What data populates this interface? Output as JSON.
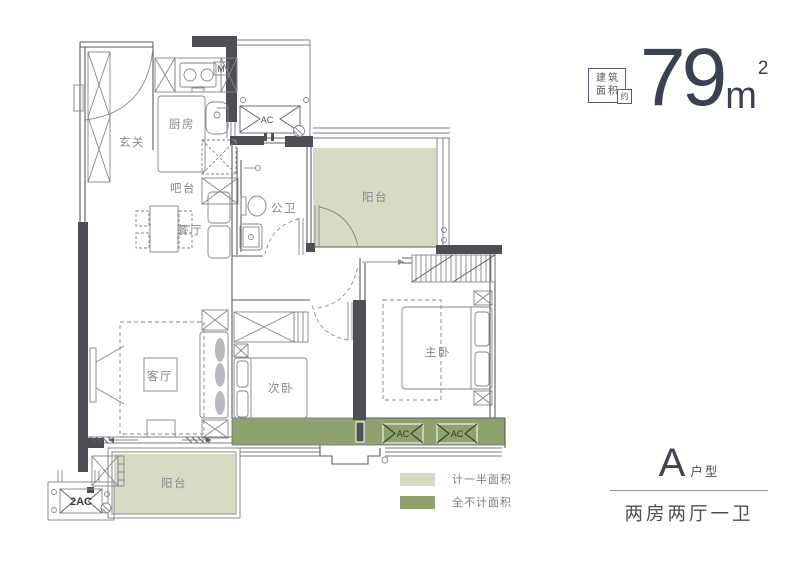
{
  "header": {
    "badge": {
      "line1": "建筑",
      "line2": "面积",
      "approx": "约"
    },
    "area": {
      "value": "79",
      "unit": "m",
      "superscript": "2"
    }
  },
  "plan": {
    "labels": {
      "entrance": "玄关",
      "kitchen": "厨房",
      "bar": "吧台",
      "dining": "餐厅",
      "bathroom": "公卫",
      "balcony_top": "阳台",
      "living": "客厅",
      "bedroom_second": "次卧",
      "bedroom_master": "主卧",
      "balcony_bottom": "阳台",
      "gas_meter": "M",
      "ac_top": "AC",
      "ac_master_left": "AC",
      "ac_master_right": "AC",
      "ac_outdoor": "2AC"
    }
  },
  "legend": {
    "items": [
      {
        "label": "计一半面积",
        "color": "#d8dac4"
      },
      {
        "label": "全不计面积",
        "color": "#8da26c"
      }
    ]
  },
  "footer": {
    "type_letter": "A",
    "type_suffix": "户型",
    "layout": "两房两厅一卫"
  },
  "colors": {
    "area_half": "#d8dac4",
    "area_excluded": "#8da26c",
    "wall": "#4e4f55",
    "accent": "#3b4053"
  }
}
